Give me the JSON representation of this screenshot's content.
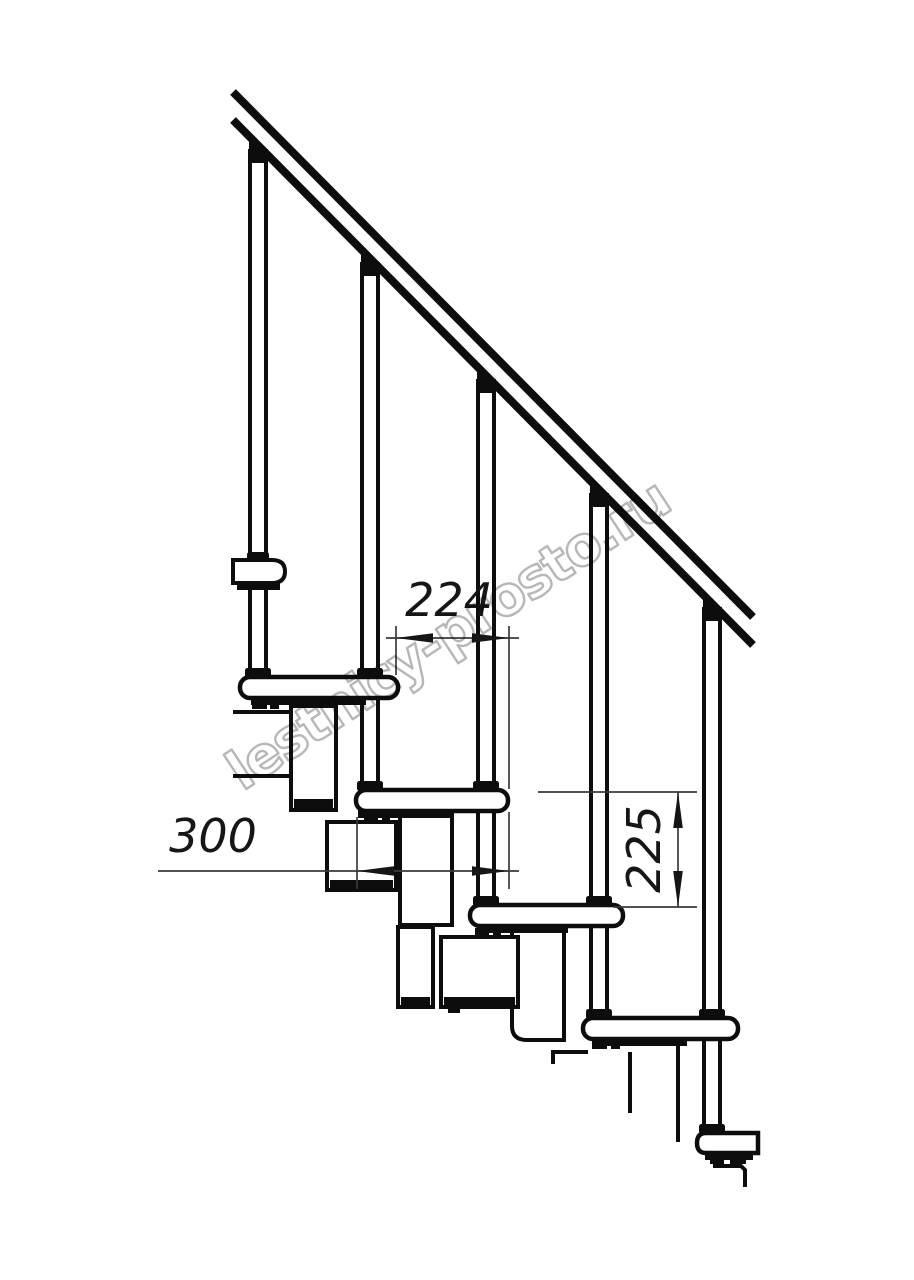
{
  "drawing": {
    "type": "staircase-side-view-technical-drawing",
    "watermark": {
      "text": "lestnicy-prosto.ru",
      "color": "#b3b3b3"
    },
    "dimensions": {
      "run": {
        "label": "224",
        "orientation": "horizontal"
      },
      "depth": {
        "label": "300",
        "orientation": "horizontal"
      },
      "rise": {
        "label": "225",
        "orientation": "vertical"
      }
    },
    "colors": {
      "ink": "#0d0d0d",
      "dimension_line": "#3a3a3a",
      "dimension_text": "#161616",
      "background": "#ffffff"
    }
  }
}
